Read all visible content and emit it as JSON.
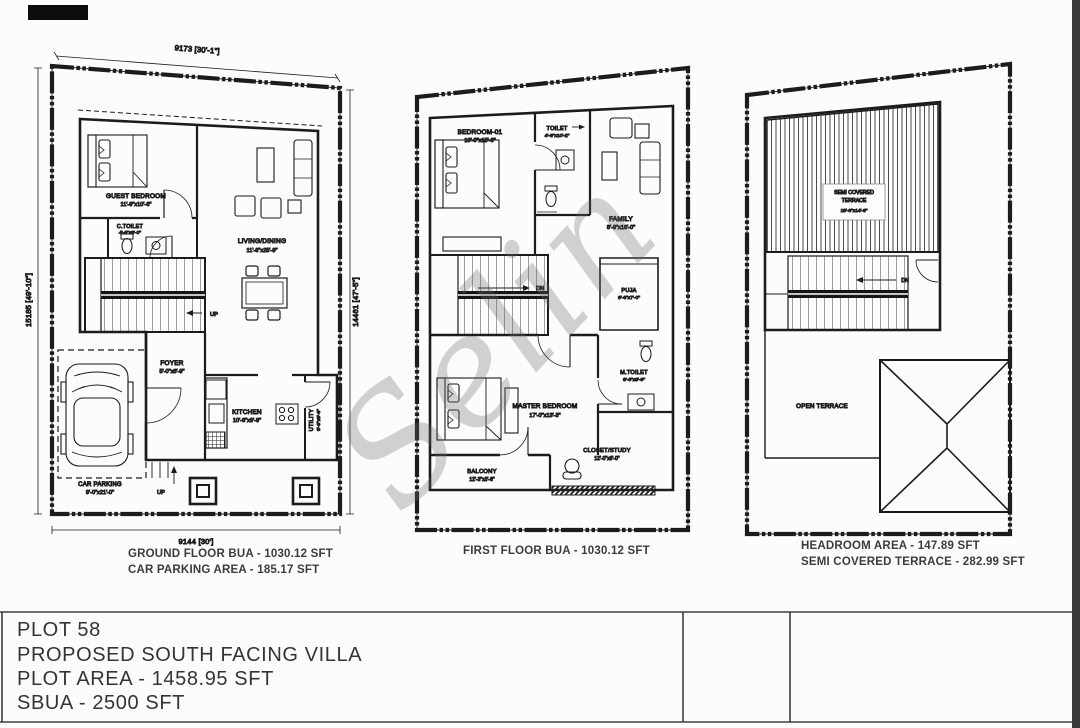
{
  "watermark": "Selin",
  "title_block": {
    "plot": "PLOT 58",
    "proposal": "PROPOSED  SOUTH FACING VILLA",
    "plot_area": "PLOT AREA - 1458.95 SFT",
    "sbua": "SBUA - 2500 SFT"
  },
  "ground_floor": {
    "caption1": "GROUND FLOOR BUA - 1030.12 SFT",
    "caption2": "CAR PARKING AREA - 185.17 SFT",
    "dims": {
      "top": "9173 [30'-1\"]",
      "left": "15185 [49'-10\"]",
      "right": "14461 [47'-5\"]",
      "bottom": "9144 [30']"
    },
    "rooms": {
      "guest_bedroom": {
        "name": "GUEST BEDROOM",
        "size": "11'-9\"x10'-6\""
      },
      "c_toilet": {
        "name": "C.TOILET",
        "size": "4'-6\"x8'-0\""
      },
      "living_dining": {
        "name": "LIVING/DINING",
        "size": "11'-6\"x25'-9\""
      },
      "foyer": {
        "name": "FOYER",
        "size": "5'-0\"x8'-9\""
      },
      "kitchen": {
        "name": "KITCHEN",
        "size": "10'-6\"x9'-9\""
      },
      "utility": {
        "name": "UTILITY",
        "size": "3'-9\"x9'-9\""
      },
      "car_parking": {
        "name": "CAR PARKING",
        "size": "9'-0\"x21'-0\""
      }
    },
    "labels": {
      "up": "UP"
    }
  },
  "first_floor": {
    "caption1": "FIRST FLOOR BUA - 1030.12 SFT",
    "rooms": {
      "bedroom_01": {
        "name": "BEDROOM-01",
        "size": "10'-0\"x15'-6\""
      },
      "toilet": {
        "name": "TOILET",
        "size": "4'-6\"x10'-2\""
      },
      "family": {
        "name": "FAMILY",
        "size": "8'-9\"x16'-0\""
      },
      "puja": {
        "name": "PUJA",
        "size": "6'-6\"x7'-0\""
      },
      "master_bedroom": {
        "name": "MASTER BEDROOM",
        "size": "17'-0\"x13'-3\""
      },
      "m_toilet": {
        "name": "M.TOILET",
        "size": "6'-6\"x8'-9\""
      },
      "closet_study": {
        "name": "CLOSET/STUDY",
        "size": "12'-0\"x8'-0\""
      },
      "balcony": {
        "name": "BALCONY",
        "size": "12'-3\"x3'-6\""
      }
    },
    "labels": {
      "dn": "DN"
    }
  },
  "terrace": {
    "caption1": "HEADROOM AREA - 147.89 SFT",
    "caption2": "SEMI COVERED TERRACE - 282.99 SFT",
    "rooms": {
      "semi_covered_terrace": {
        "name_line1": "SEMI COVERED",
        "name_line2": "TERRACE",
        "size": "19'-6\"x14'-6\""
      },
      "open_terrace": {
        "name": "OPEN TERRACE"
      }
    },
    "labels": {
      "dn": "DN"
    }
  }
}
